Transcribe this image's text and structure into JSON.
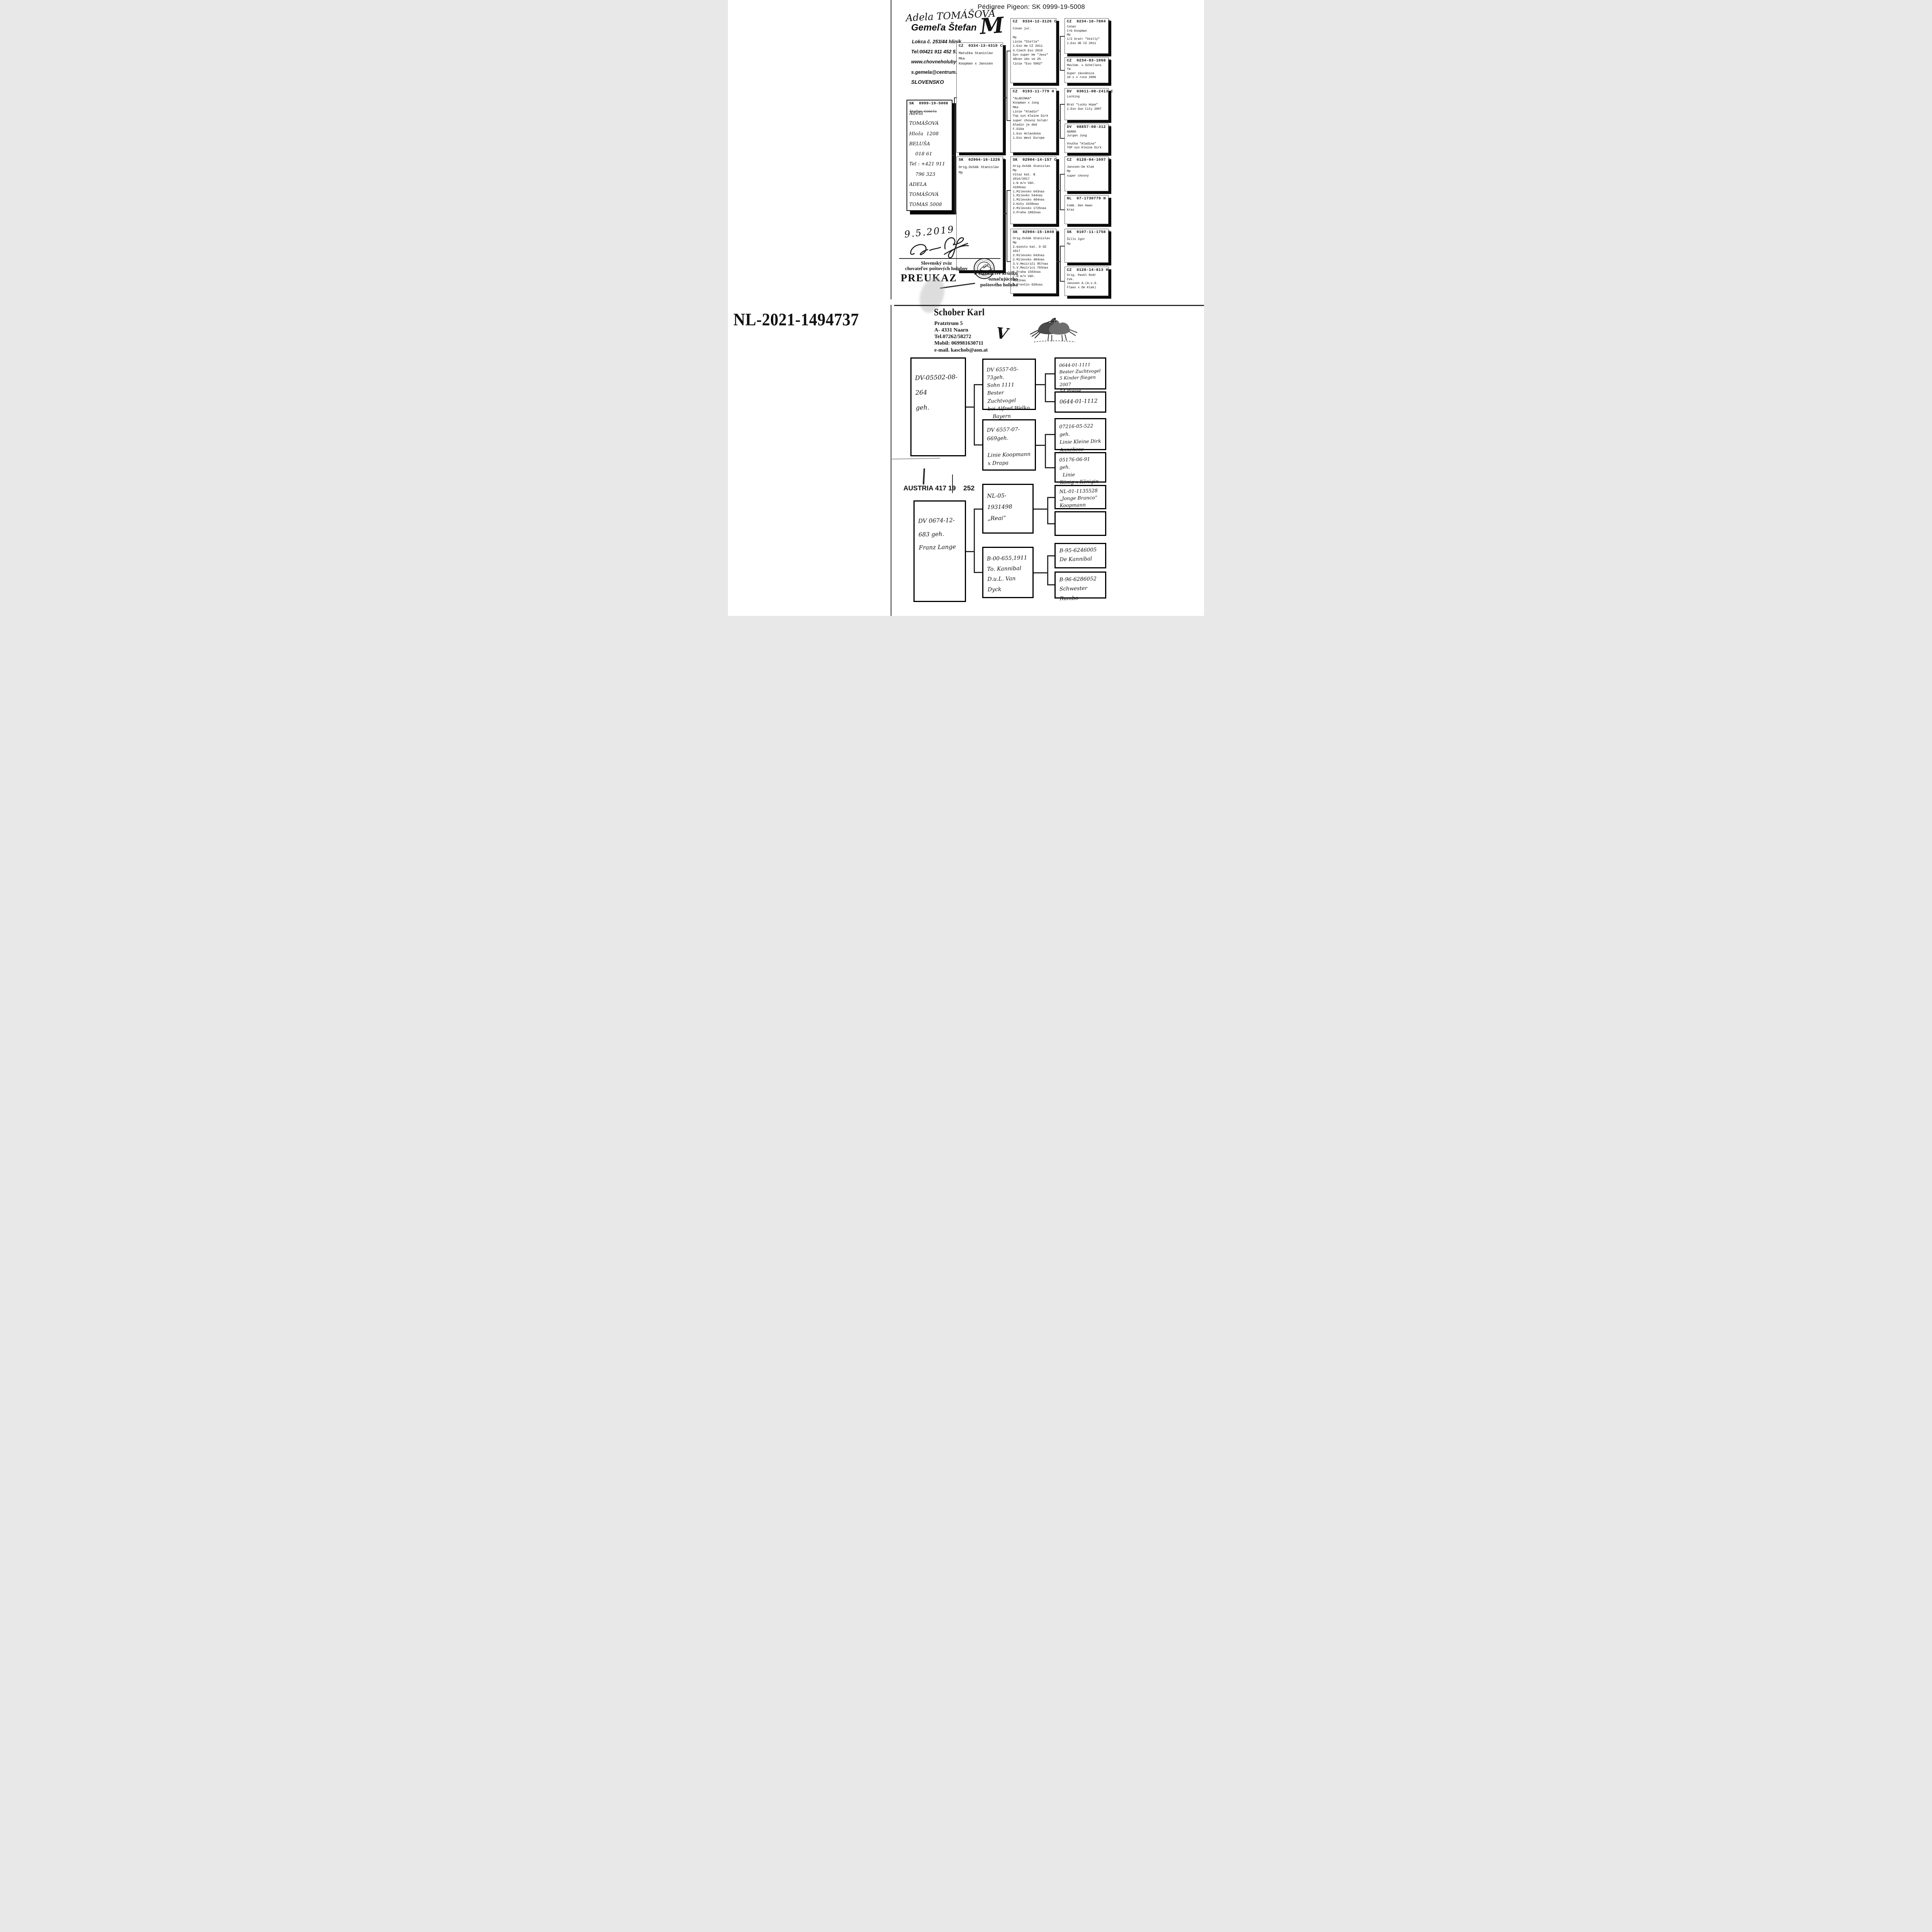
{
  "top_doc": {
    "title": "Pédigree Pigeon: SK  0999-19-5008",
    "owner_handwritten": "Adela TOMÁŠOVÁ",
    "owner_mark": "M",
    "breeder": {
      "name": "Gemeľa Štefan",
      "address": "Lokca č. 253/44 hliník",
      "tel": "Tel:00421 911 452 512",
      "web": "www.chovneholuby.sk",
      "email": "s.gemela@centrum.sk",
      "country": "SLOVENSKO"
    },
    "subject": {
      "ring": "SK  0999-19-5008",
      "printed_name": "Štefan Gemeľa",
      "handwritten": "Adela TOMÁŠOVÁ\nHloža  1208\nBELUŠA\n    018 61\nTel : +421 911\n    796 323\nADELA TOMÁŠOVÁ\nTOMAS 5008"
    },
    "boxes": [
      {
        "ring": "CZ  0334-13-4319 C",
        "body": "Matuška Stanislav\nMka\nKoopman x Janssen"
      },
      {
        "ring": "SK  02904-16-1226 H",
        "body": "Orig.Ovšák Stanislav\nMp"
      },
      {
        "ring": "CZ  0334-12-3126 C",
        "body": "Conan jur.\n\nMp\nLinie \"Stella\"\n1.Eso He CZ 2011\n4.Czech Eso 2010\nSyn super He \"Jess\"\n48cen 18x ve 2%\nlinie \"Eso 5002\""
      },
      {
        "ring": "CZ  0193-11-779 H",
        "body": "\"ALADINKA\"\nKoopman x Jung\nMka\nLinie \"Aladin\"\nTop syn Kleine Dirk\nsuper chovný holub!\nAladin je ded\nF.Diba\n1.Eso Holandska\n1.Eso West Europe"
      },
      {
        "ring": "SK  02904-14-157 C",
        "body": "Orig.Ovšák Stanislav\nMp\nVitaz kat. B\n2016/2017\n1.N m/n Váh.\n4160nas\n1.Milevsko 643nas\n1.Milevko 544nas\n1.Milevsko 484nas\n2.Kúty 4339nas\n2.Milevsko 1725nas\n3.Praha 1882nas"
      },
      {
        "ring": "SK  02904-15-1049 H",
        "body": "Orig.Ovšák Stanislav\nMp\n2.miesto kat. D OZ\n2017\n2.Milevsko 643nas\n2.Milevsko 484nas\n3.V.Meziričí 957nas\n5.V.Mezirici 703nas\n6.Praha 1503nas\n7.N m/n Váh.\n4122nas\n8.Trenčín 820nas"
      },
      {
        "ring": "CZ  0234-10-7804 C",
        "body": "Conan\nC+G Koopman\nMp\n1/2 bratr \"Stelly\"\n1.Eso HE CZ 2011"
      },
      {
        "ring": "CZ  0234-03-1068 H",
        "body": "Meulem. x Schellens\nTm\nSuper závodnice\n10 x v roce 2006"
      },
      {
        "ring": "DV  03611-08-2413 C",
        "body": "Lucking\n\nBrat \"Lucky Hope\"\n1.Eso Sun City 2007"
      },
      {
        "ring": "DV  08857-08-312 H",
        "body": "ADARA\nJurgen Jung\n\nVnučka \"Aladina\"\nTOP syn Kleine Dirk"
      },
      {
        "ring": "CZ  0128-04-1097 C",
        "body": "Janssen-De Klak\nMp\nsuper chovný"
      },
      {
        "ring": "NL  07-1730779 H",
        "body": "Comb. Den Haan\nKras"
      },
      {
        "ring": "SK  0107-11-1758 C",
        "body": "Šillo Igor\nMp"
      },
      {
        "ring": "CZ  0128-14-813 H",
        "body": "Orig. Pavel Rodr\nčvk.\nJanssen A.(A.v.d.\nFlaes x De Klak)"
      }
    ],
    "date_handwritten": "9.5.2019",
    "stamp": {
      "org": "Slovenský zväz\nchovateľov poštových holubov",
      "preukaz": "PREUKAZ",
      "right": "o vlastníctve krúžku\noznačujúceho\npoštového holuba"
    }
  },
  "bottom_doc": {
    "big_ring": "NL-2021-1494737",
    "owner": {
      "name": "Schober Karl",
      "address1": "Pratztrum 5",
      "address2": "A- 4331  Naarn",
      "tel": "Tel.07262/58272",
      "mobil": "Mobil: 069981630711",
      "email": "e-mail.  kaschob@aon.at"
    },
    "check_mark": "V",
    "austria_line": "AUSTRIA 417 19    252",
    "boxes": [
      {
        "body": "DV-05502-08-264\ngeh."
      },
      {
        "body": "DV 0674-12-683 geh.\nFranz Lange"
      },
      {
        "body": "DV 6557-05-73geh.\nSohn 1111\nBester Zuchtvogel\nbei Alfred Welko\n   Bayern"
      },
      {
        "body": "DV 6557-07-669geh.\n\nLinie Koopmann\nx Drapa"
      },
      {
        "body": "NL-05-1931498\n„Reai“"
      },
      {
        "body": "B-00-655,1911\nTo. Kannibal\nD.u.L. Van Dyck"
      },
      {
        "body": "0644-01-1111\nBester Zuchtvogel\n5 Kinder fliegen 2007\n54 Preise"
      },
      {
        "body": "0644-01-1112"
      },
      {
        "body": "07216-05-522 geh.\nLinie Kleine Dirk\nAnneliese"
      },
      {
        "body": "05176-06-91 geh.\n  Linie\nKönig x Königin"
      },
      {
        "body": "NL-01-1135528\n„Jonge Branco“\nKoopmann"
      },
      {
        "body": ""
      },
      {
        "body": "B-95-6246005\nDe Kannibal"
      },
      {
        "body": "B-96-6286052\nSchwester Rambo"
      }
    ]
  }
}
